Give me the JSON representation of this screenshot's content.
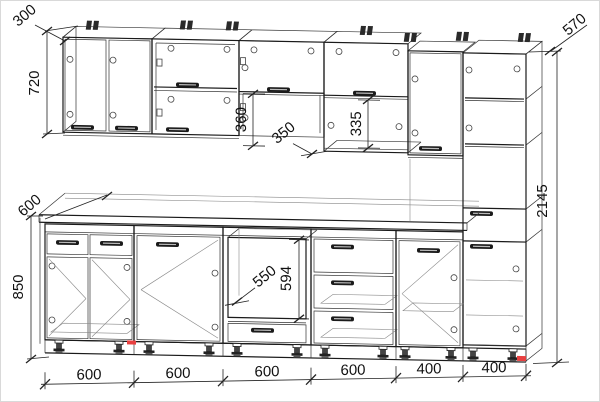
{
  "drawing": {
    "title": "kitchen-cabinet-assembly-blueprint",
    "line_color": "#1a1a1a",
    "accent_red": "#e84040",
    "dims": {
      "wall_depth": "300",
      "wall_height": "720",
      "open_gap": "360",
      "shelf_depth": "350",
      "shelf_gap": "335",
      "tall_depth": "570",
      "tall_height": "2145",
      "counter_depth": "600",
      "base_height": "850",
      "oven_width": "550",
      "oven_height": "594",
      "bottom_widths": [
        "600",
        "600",
        "600",
        "600",
        "400",
        "400"
      ]
    }
  }
}
